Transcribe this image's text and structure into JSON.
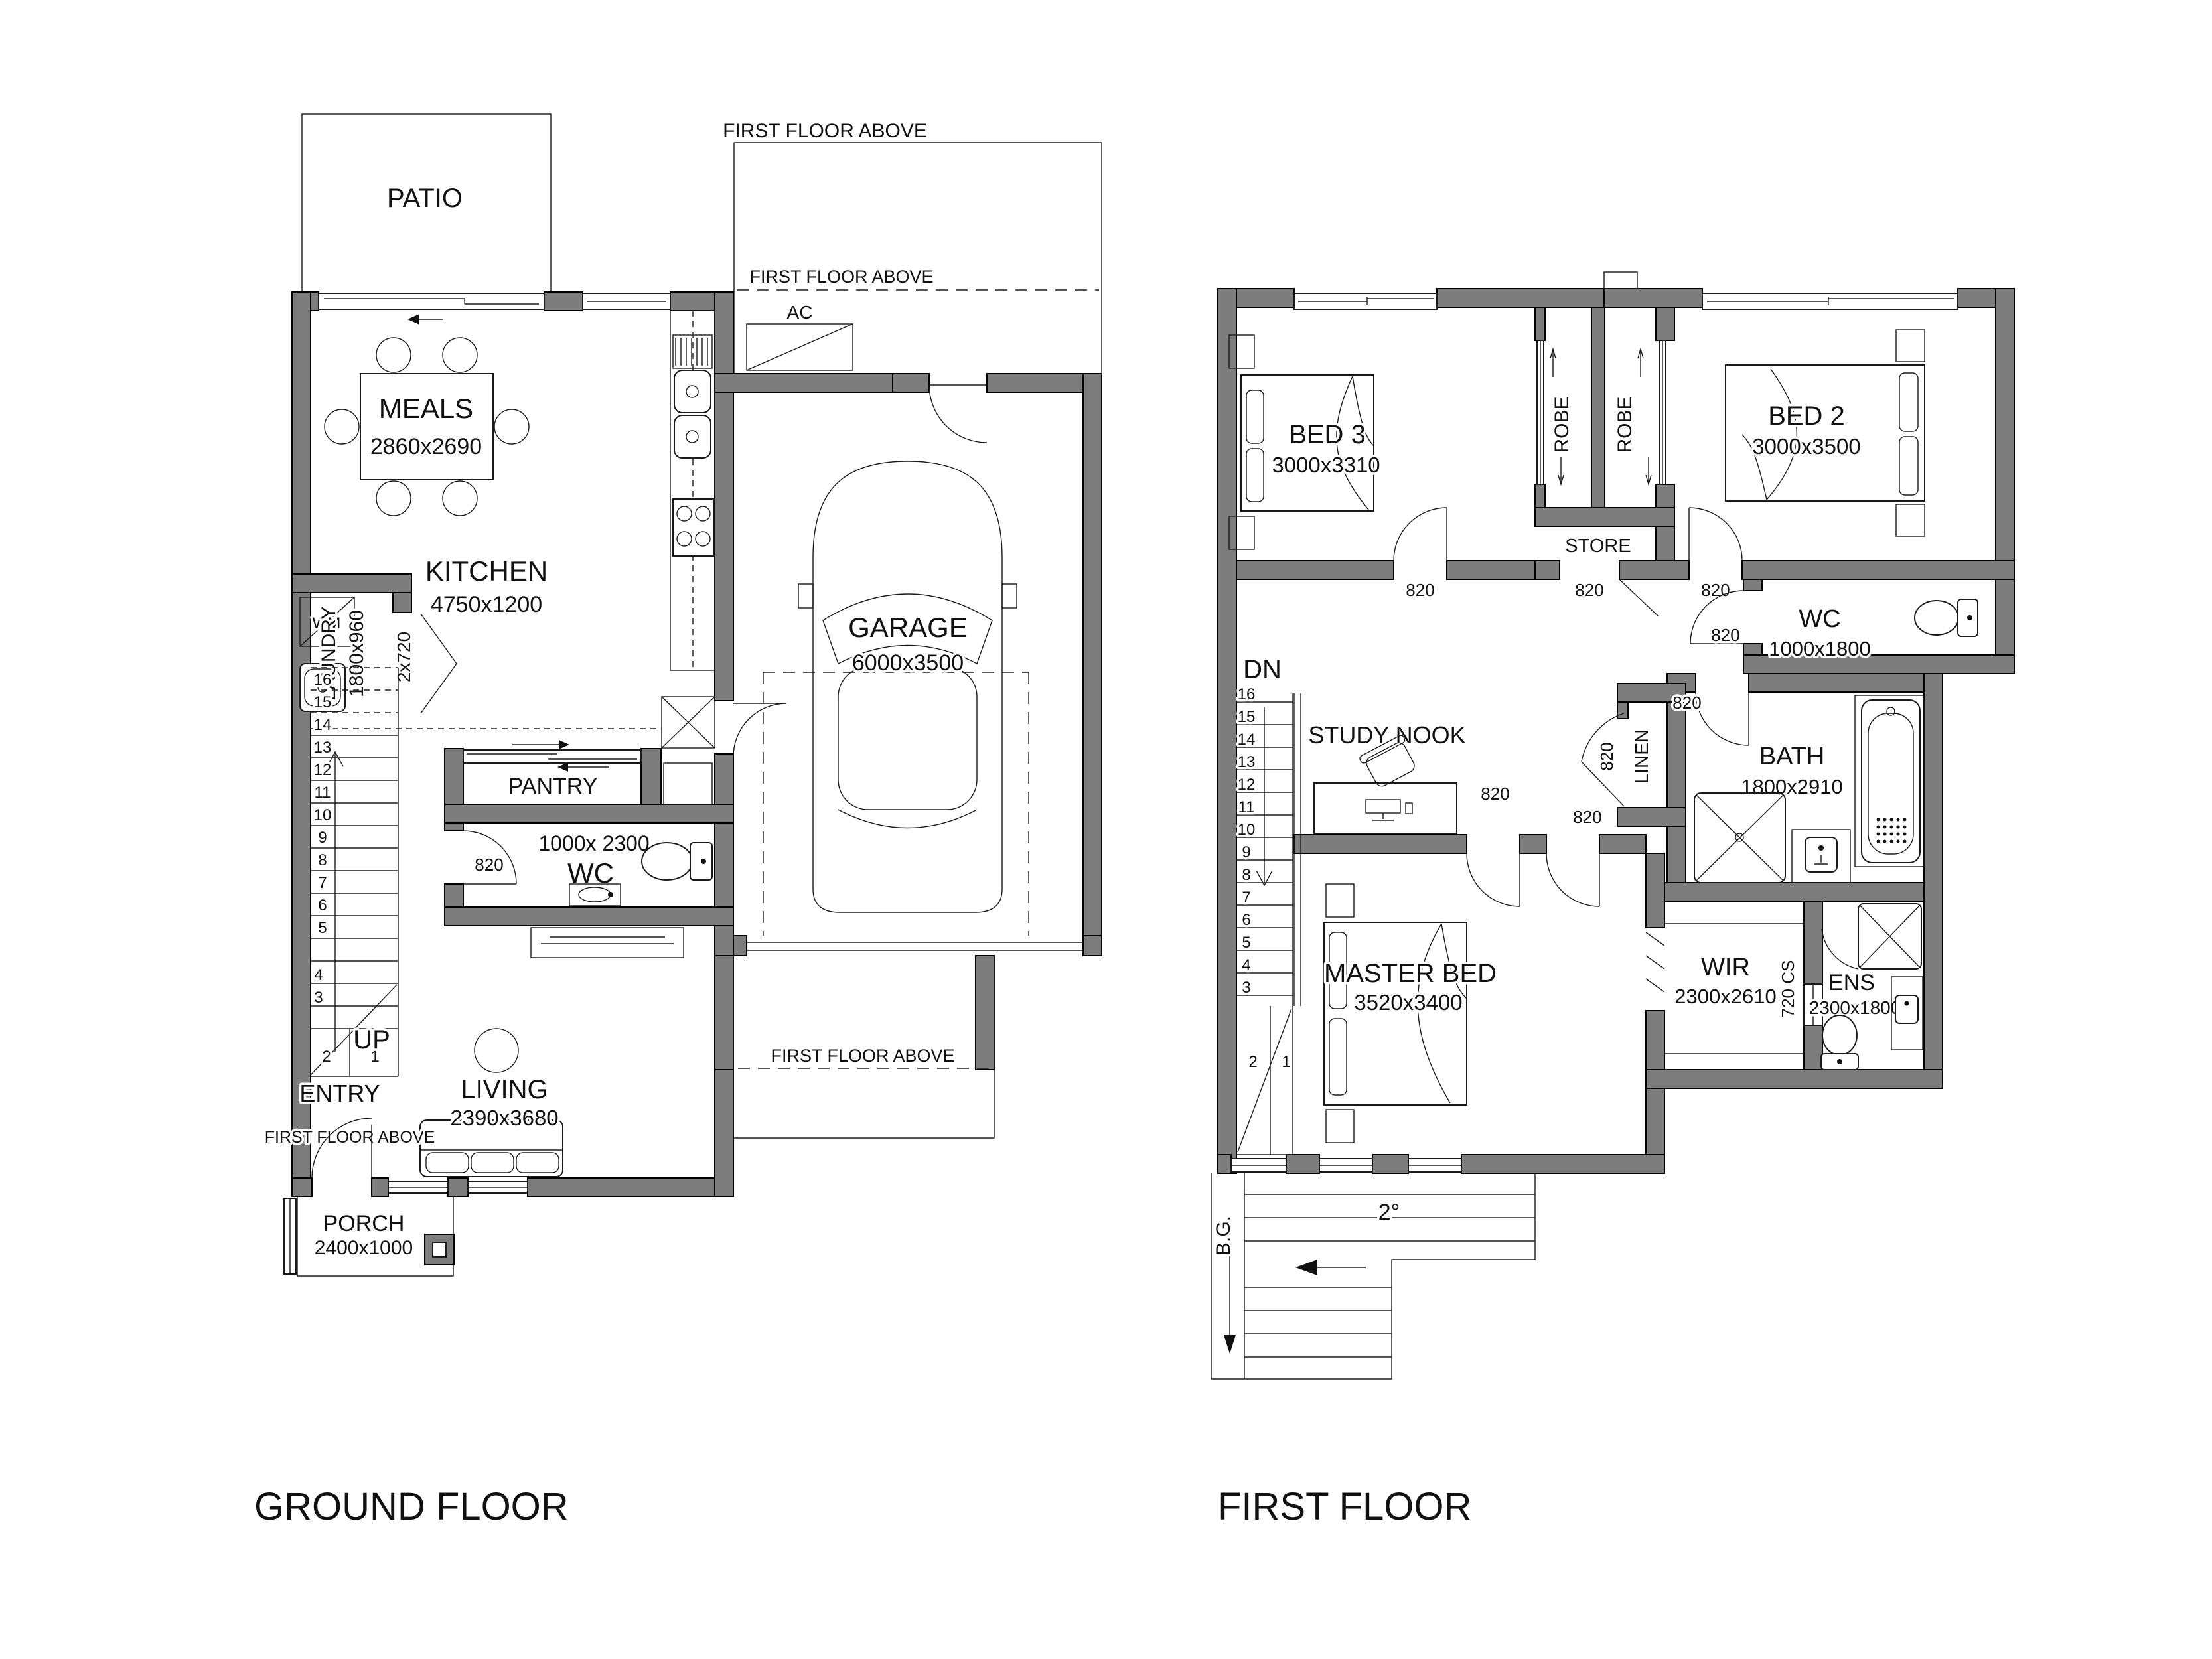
{
  "titles": {
    "ground": "GROUND FLOOR",
    "first": "FIRST FLOOR"
  },
  "common": {
    "ffa": "FIRST FLOOR ABOVE",
    "ac": "AC",
    "d820": "820"
  },
  "ground": {
    "patio": "PATIO",
    "meals": {
      "name": "MEALS",
      "dim": "2860x2690"
    },
    "kitchen": {
      "name": "KITCHEN",
      "dim": "4750x1200"
    },
    "garage": {
      "name": "GARAGE",
      "dim": "6000x3500"
    },
    "laundry": {
      "name": "LAUNDRY",
      "dim": "1800x960",
      "door": "2x720",
      "wm": "WM"
    },
    "pantry": "PANTRY",
    "wc": {
      "dim": "1000x 2300",
      "name": "WC"
    },
    "up": "UP",
    "entry": "ENTRY",
    "living": {
      "name": "LIVING",
      "dim": "2390x3680"
    },
    "porch": {
      "name": "PORCH",
      "dim": "2400x1000"
    },
    "stairs": [
      "1",
      "2",
      "3",
      "4",
      "5",
      "6",
      "7",
      "8",
      "9",
      "10",
      "11",
      "12",
      "13",
      "14",
      "15",
      "16"
    ]
  },
  "first": {
    "bed3": {
      "name": "BED 3",
      "dim": "3000x3310"
    },
    "bed2": {
      "name": "BED 2",
      "dim": "3000x3500"
    },
    "robe": "ROBE",
    "store": "STORE",
    "dn": "DN",
    "study": "STUDY NOOK",
    "linen": "LINEN",
    "wc": {
      "name": "WC",
      "dim": "1000x1800"
    },
    "bath": {
      "name": "BATH",
      "dim": "1800x2910"
    },
    "master": {
      "name": "MASTER BED",
      "dim": "3520x3400"
    },
    "wir": {
      "name": "WIR",
      "dim": "2300x2610"
    },
    "ens": {
      "name": "ENS",
      "dim": "2300x1800"
    },
    "cs": "720 CS",
    "bg": "B.G.",
    "slope": "2°",
    "stairs": [
      "1",
      "2",
      "3",
      "4",
      "5",
      "6",
      "7",
      "8",
      "9",
      "10",
      "11",
      "12",
      "13",
      "14",
      "15",
      "16"
    ]
  }
}
